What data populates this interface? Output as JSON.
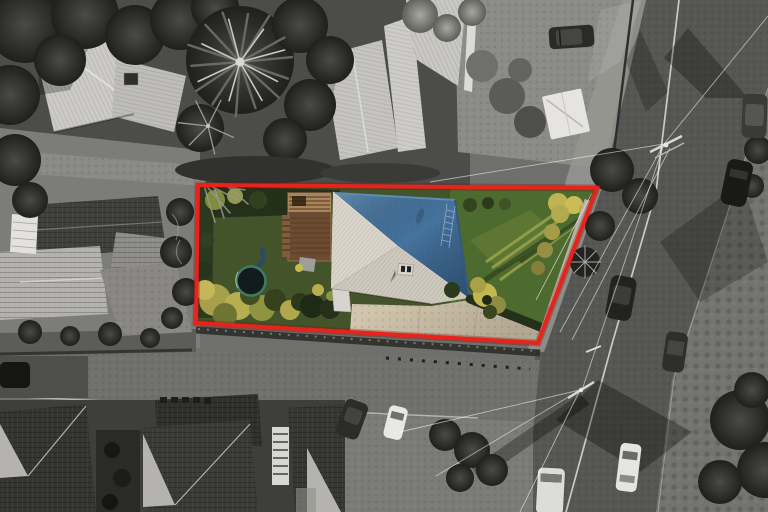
{
  "image": {
    "kind": "aerial-property-photo",
    "width": 768,
    "height": 512
  },
  "boundary": {
    "label": "property-boundary",
    "color": "#e6231c",
    "glow_color": "#7a0f0a",
    "corners": [
      [
        198,
        185
      ],
      [
        597,
        188
      ],
      [
        538,
        343
      ],
      [
        196,
        323
      ]
    ]
  },
  "property": {
    "roof_blue": "#46749f",
    "roof_light": "#ccc6bc",
    "lawn_left": "#43532a",
    "lawn_right": "#4d6a2f",
    "hedge_dark": "#243019",
    "shrub_yellow": "#b3a94e",
    "deck_wood": "#6b4b31",
    "deck_pergola": "#a8855a",
    "trampoline_mat": "#121c1e",
    "trampoline_rim": "#3e7a64",
    "driveway": "#c8bca7",
    "features": [
      "blue-hip-roof-house",
      "light-metal-roof-section",
      "wooden-deck",
      "trampoline",
      "concrete-driveway",
      "front-lawn",
      "back-lawn",
      "boundary-hedges",
      "side-path"
    ]
  },
  "surroundings": {
    "style": "grayscale",
    "road_asphalt": "#565654",
    "pavement": "#8b8b87",
    "townhouse_roof": "#343432",
    "features": [
      "main-road",
      "frontage-road",
      "footpath",
      "townhouse-roofs",
      "neighbor-house-north",
      "neighbor-house-west",
      "palm-tree",
      "power-poles",
      "power-lines",
      "parked-cars",
      "street-trees"
    ],
    "visible_car_count": 11
  }
}
